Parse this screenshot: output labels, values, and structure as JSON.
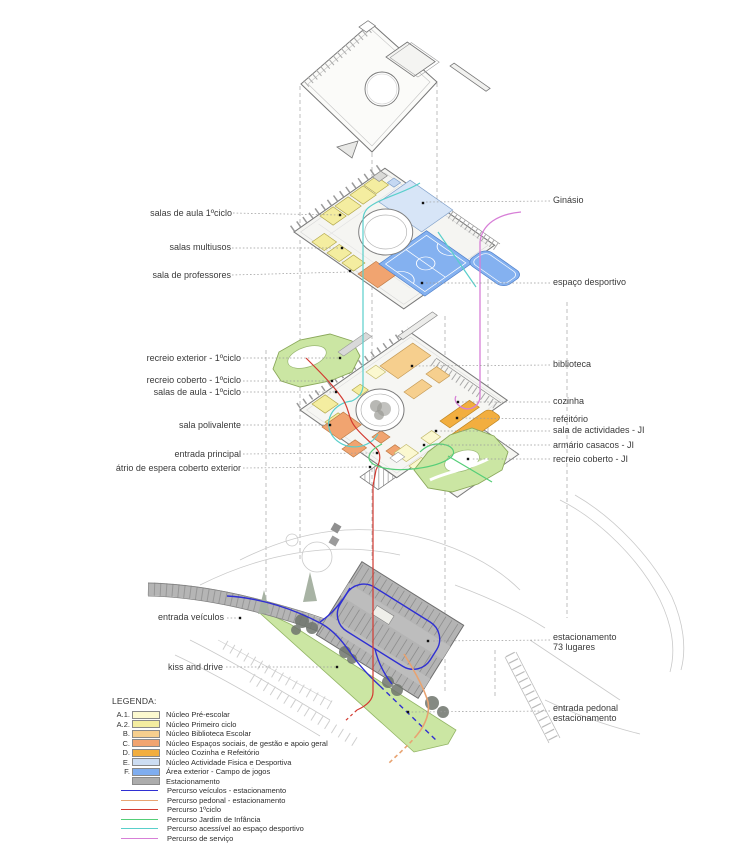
{
  "figure": {
    "kind": "exploded axonometric school design diagram",
    "colors": {
      "outline": "#777777",
      "leader": "#9b9b9b",
      "site_gray": "#b4b4b4",
      "green_area": "#cbe6a3"
    }
  },
  "labels": {
    "left": [
      {
        "text": "salas de aula 1ºciclo"
      },
      {
        "text": "salas multiusos"
      },
      {
        "text": "sala de professores"
      },
      {
        "text": "recreio exterior - 1ºciclo"
      },
      {
        "text": "recreio coberto - 1ºciclo"
      },
      {
        "text": "salas de aula - 1ºciclo"
      },
      {
        "text": "sala polivalente"
      },
      {
        "text": "entrada principal"
      },
      {
        "text": "átrio de espera coberto exterior"
      },
      {
        "text": "entrada veículos"
      },
      {
        "text": "kiss and drive"
      }
    ],
    "right": [
      {
        "text": "Ginásio"
      },
      {
        "text": "espaço desportivo"
      },
      {
        "text": "biblioteca"
      },
      {
        "text": "cozinha"
      },
      {
        "text": "refeitório"
      },
      {
        "text": "sala de actividades - JI"
      },
      {
        "text": "armário casacos - JI"
      },
      {
        "text": "recreio coberto - JI"
      },
      {
        "line1": "estacionamento",
        "line2": "73 lugares"
      },
      {
        "line1": "entrada pedonal",
        "line2": "estacionamento"
      }
    ]
  },
  "legend": {
    "heading": "LEGENDA:",
    "area_items": [
      {
        "key": "A.1.",
        "label": "Núcleo Pré-escolar",
        "color": "#fcf9cf"
      },
      {
        "key": "A.2.",
        "label": "Núcleo Primeiro ciclo",
        "color": "#f4eda0"
      },
      {
        "key": "B.",
        "label": "Núcleo Biblioteca Escolar",
        "color": "#f6cf8e"
      },
      {
        "key": "C.",
        "label": "Núcleo Espaços sociais, de gestão e apoio geral",
        "color": "#f1a470"
      },
      {
        "key": "D.",
        "label": "Núcleo Cozinha e Refeitório",
        "color": "#f2ae3f"
      },
      {
        "key": "E.",
        "label": "Núcleo Actividade Fisica e Desportiva",
        "color": "#cdddf2"
      },
      {
        "key": "F.",
        "label": "Área exterior - Campo de jogos",
        "color": "#7fadef"
      },
      {
        "key": "",
        "label": "Estacionamento",
        "color": "#acacac"
      }
    ],
    "route_items": [
      {
        "label": "Percurso veículos - estacionamento",
        "color": "#2f2fd3"
      },
      {
        "label": "Percurso pedonal - estacionamento",
        "color": "#e8a371"
      },
      {
        "label": "Percurso 1ºciclo",
        "color": "#d33a31"
      },
      {
        "label": "Percurso Jardim de Infância",
        "color": "#55ce78"
      },
      {
        "label": "Percurso acessível ao espaço desportivo",
        "color": "#59cfcb"
      },
      {
        "label": "Percurso de serviço",
        "color": "#d77fd7"
      }
    ]
  }
}
